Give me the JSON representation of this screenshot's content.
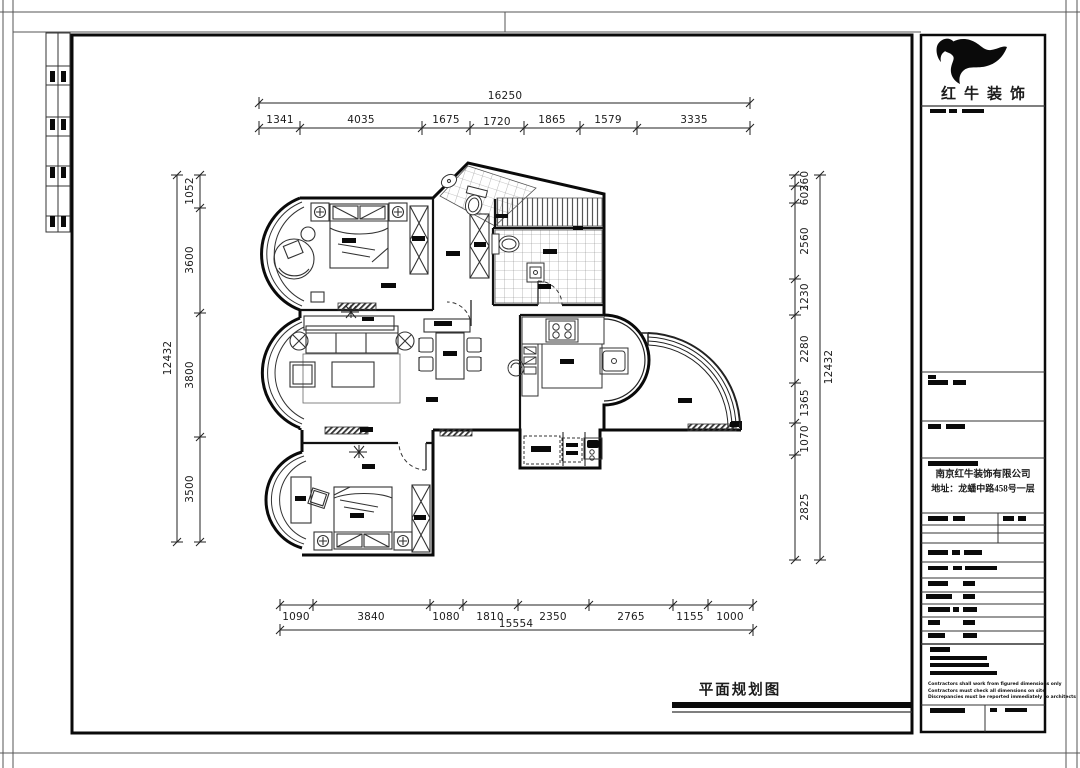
{
  "drawing": {
    "title": "平面规划图"
  },
  "title_block": {
    "brand": "红牛装饰",
    "company": "南京红牛装饰有限公司",
    "address": "地址：龙蟠中路458号一层",
    "notes": [
      "Contractors shall work from figured dimensions only",
      "Contractors must check all dimensions on site",
      "Discrepancies must be reported immediately to architects"
    ]
  },
  "dimensions": {
    "top": {
      "total": "16250",
      "segments": [
        "1341",
        "4035",
        "1675",
        "1720",
        "1865",
        "1579",
        "3335"
      ]
    },
    "bottom": {
      "total": "15554",
      "segments": [
        "1090",
        "3840",
        "1080",
        "1810",
        "2350",
        "2765",
        "1155",
        "1000"
      ]
    },
    "left": {
      "total": "12432",
      "segments": [
        "1052",
        "3600",
        "3800",
        "3500"
      ]
    },
    "right": {
      "total": "12432",
      "segments": [
        "360",
        "602",
        "2560",
        "1230",
        "2280",
        "1365",
        "1070",
        "2825"
      ]
    }
  }
}
